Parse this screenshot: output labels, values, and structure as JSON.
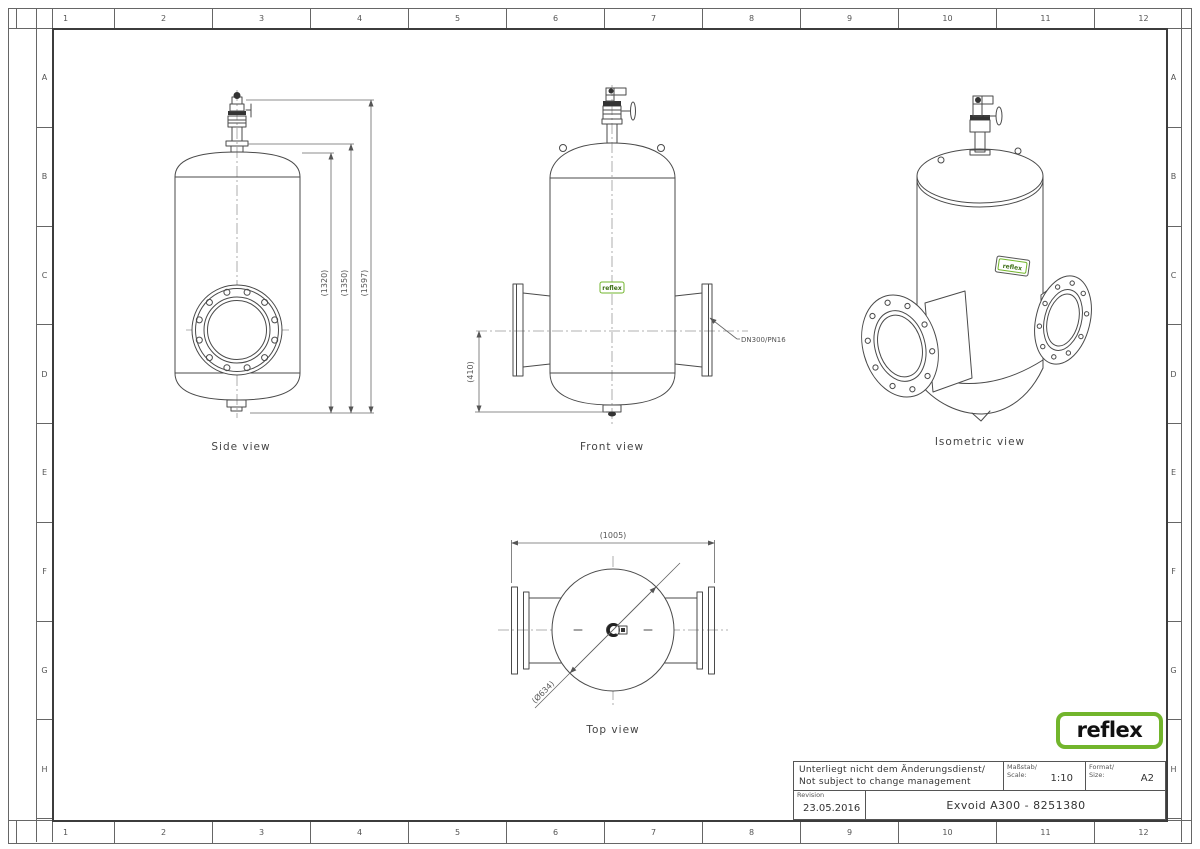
{
  "border": {
    "columns": [
      "1",
      "2",
      "3",
      "4",
      "5",
      "6",
      "7",
      "8",
      "9",
      "10",
      "11",
      "12"
    ],
    "rows": [
      "A",
      "B",
      "C",
      "D",
      "E",
      "F",
      "G",
      "H"
    ]
  },
  "views": {
    "side": {
      "label": "Side view",
      "dim_1320": "(1320)",
      "dim_1350": "(1350)",
      "dim_1597": "(1597)"
    },
    "front": {
      "label": "Front view",
      "dim_height": "(410)",
      "nozzle_spec": "DN300/PN16"
    },
    "isometric": {
      "label": "Isometric view"
    },
    "top": {
      "label": "Top view",
      "dim_width": "(1005)",
      "dim_diameter": "(Ø634)"
    }
  },
  "branding": {
    "logo_text": "reflex",
    "sticker_text": "reflex",
    "green": "#72b52c"
  },
  "title_block": {
    "note_line1": "Unterliegt nicht dem Änderungsdienst/",
    "note_line2": "Not subject to change management",
    "scale_label_de": "Maßstab/",
    "scale_label_en": "Scale:",
    "scale_value": "1:10",
    "format_label_de": "Format/",
    "format_label_en": "Size:",
    "format_value": "A2",
    "revision_label": "Revision",
    "revision_date": "23.05.2016",
    "drawing_title": "Exvoid A300  -  8251380"
  }
}
